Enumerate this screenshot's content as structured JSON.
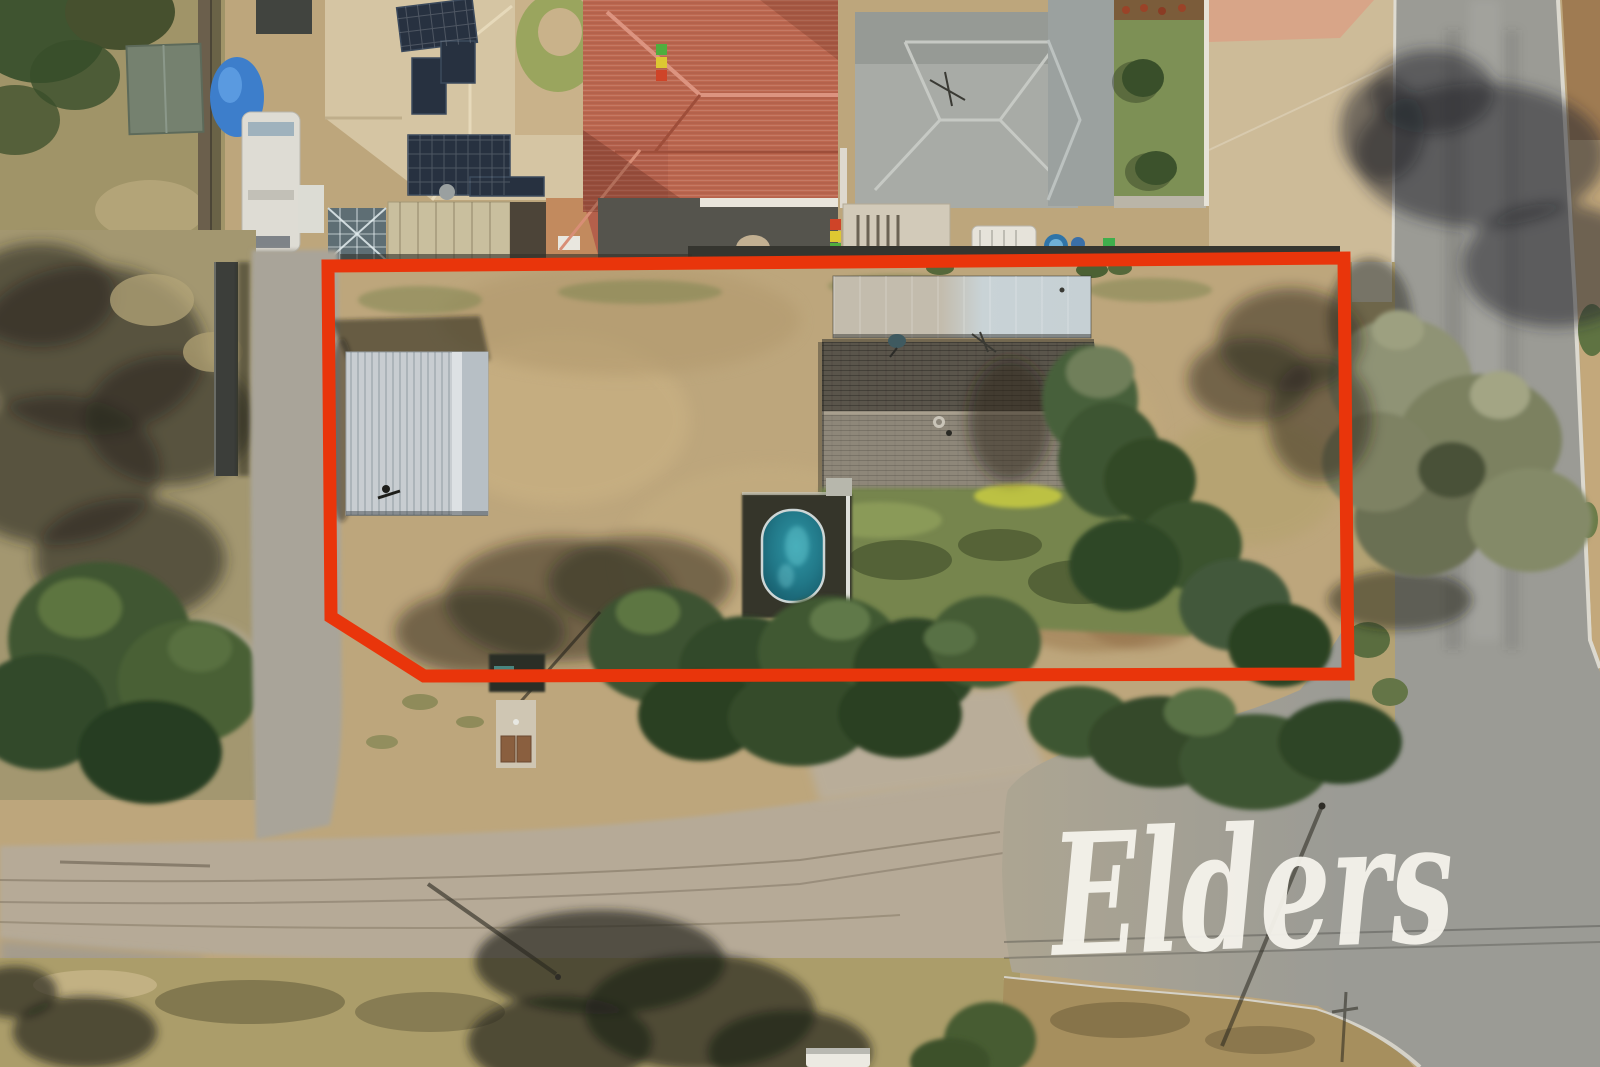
{
  "watermark": {
    "text": "Elders",
    "color": "#f6f4ed"
  },
  "boundary": {
    "color": "#e9350b",
    "stroke_width": 13,
    "points": "328,266 1344,258 1348,674 424,676 331,617"
  },
  "scene": {
    "type": "aerial-drone-photograph",
    "subject": "residential block outlined in red for sale",
    "features": [
      "red-boundary-outline",
      "garden-shed",
      "rear-shed",
      "dark-tiled-roof-house",
      "satellite-dish",
      "above-ground-pool",
      "dry-dirt-yard",
      "lawn",
      "gum-trees",
      "tree-shadows",
      "gravel-driveway",
      "dirt-road-intersection",
      "asphalt-road",
      "kerbs",
      "neighbour-houses",
      "terracotta-roof",
      "solar-panels",
      "caravans",
      "blue-tarp-car",
      "pump-shed",
      "power-pole-shadows",
      "elders-watermark"
    ],
    "colors": {
      "dirt": "#bda67c",
      "dry_grass": "#ab9d6f",
      "dirt_road": "#b6aa97",
      "asphalt": "#9b9b95",
      "pool_water": "#20788a",
      "house_roof_dark": "#5a554b",
      "house_roof_light": "#8e8779",
      "shed_roof": "#c8cdd1",
      "rear_shed_roof": "#c9d3d6",
      "terracotta_roof": "#bd6850",
      "gray_roof": "#a8aba6",
      "cream_roof": "#d5c5a3",
      "solar_panel": "#273140",
      "tree_dark": "#3c5330",
      "lawn": "#76854e",
      "boundary_red": "#e9350b",
      "watermark_white": "#f6f4ed"
    }
  }
}
